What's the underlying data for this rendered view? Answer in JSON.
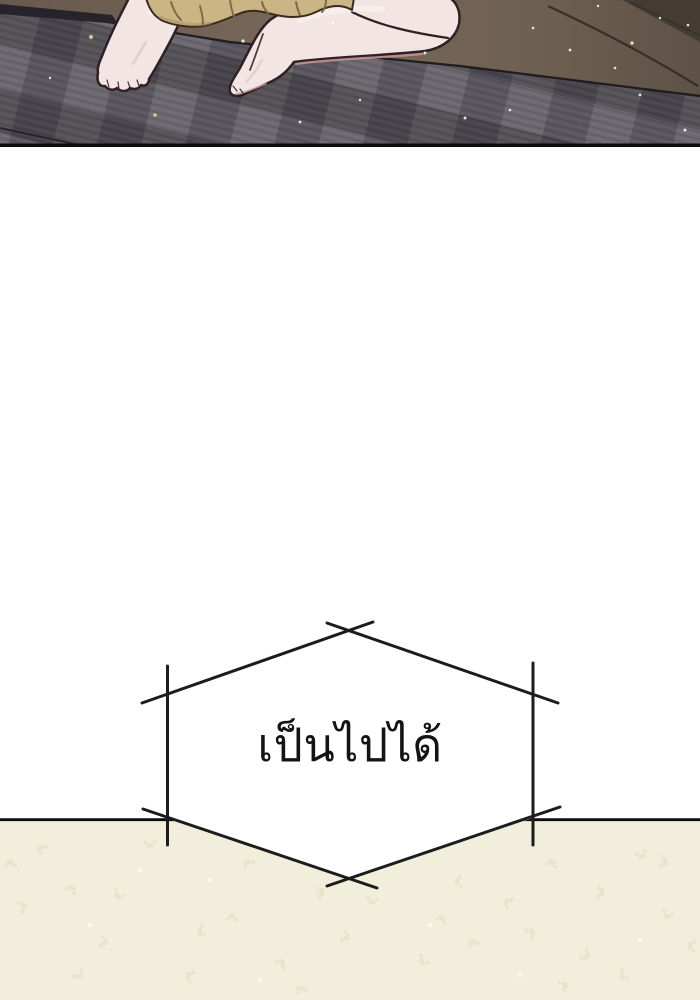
{
  "speech_bubble": {
    "text": "เป็นไปได้"
  },
  "colors": {
    "page_background": "#ffffff",
    "panel_border": "#0d0d0d",
    "floor_brown_left": "#68594d",
    "floor_brown_mid": "#77685a",
    "floor_brown_right": "#5e5146",
    "floor_corner_shadow": "#443c32",
    "floor_crease": "#2f2820",
    "mat_base": "#5b5760",
    "mat_edge": "#17161a",
    "mat_fold": "#26232a",
    "skin": "#f2e5e3",
    "skin_outline": "#2f2024",
    "skin_shadow": "#e0cbcf",
    "skin_highlight": "#fdf9f5",
    "skin_blush": "#c9939b",
    "garment": "#ccb584",
    "garment_outline": "#3a2a1e",
    "garment_fold": "#7e6a49",
    "garment_shade": "#a8926a",
    "sparkle_white": "#ffffff",
    "sparkle_green": "#d4e4a2",
    "bottom_panel": "#f2eedc",
    "speckle_dark": "#e3dbc0",
    "speckle_light": "#fdfbf0",
    "bubble_fill": "#ffffff",
    "bubble_line": "#1c1c1c",
    "text_color": "#141414"
  }
}
